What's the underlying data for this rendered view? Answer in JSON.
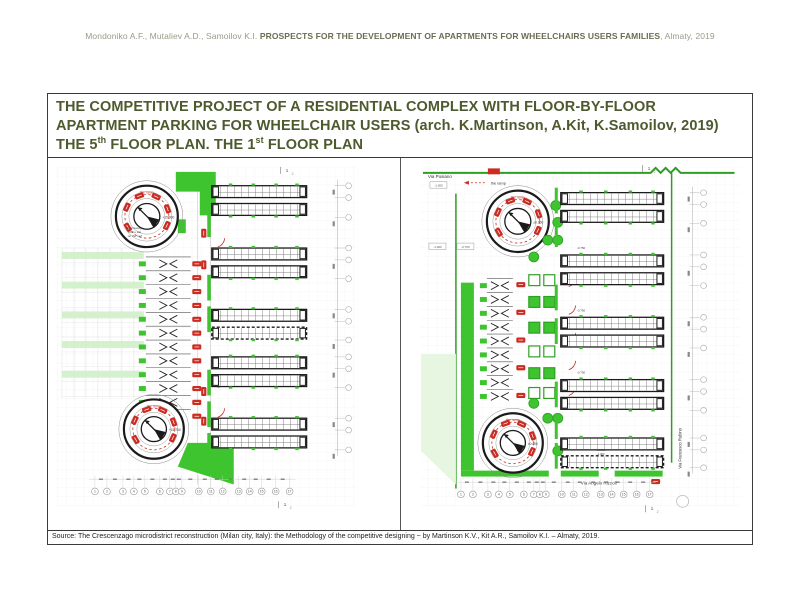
{
  "header": {
    "authors": "Mondoniko A.F., Mutaliev A.D., Samoilov K.I. ",
    "title_bold": "PROSPECTS FOR THE DEVELOPMENT OF APARTMENTS FOR WHEELCHAIRS USERS FAMILIES",
    "suffix": ", Almaty, 2019"
  },
  "title_block": {
    "line1": "THE COMPETITIVE PROJECT OF A RESIDENTIAL COMPLEX WITH FLOOR-BY-FLOOR",
    "line2": "APARTMENT PARKING FOR WHEELCHAIR USERS (arch. K.Martinson, A.Kit, K.Samoilov, 2019)",
    "line3_pre": "THE 5",
    "line3_sup1": "th",
    "line3_mid": " FLOOR PLAN. THE 1",
    "line3_sup2": "st",
    "line3_post": " FLOOR PLAN"
  },
  "source": {
    "text": "Source: The Crescenzago microdistrict reconstruction (Milan city, Italy): the Methodology of the competitive designing ~ by Martinson K.V., Kit A.R., Samoilov K.I. – Almaty, 2019."
  },
  "plans": {
    "left": {
      "name": "the-5th-floor-plan",
      "ramp_label": "the ramp",
      "ramp_note": [
        "the Passage",
        "to the site",
        "on the roof"
      ],
      "elevations": {
        "top_ramp": "+15.000",
        "bottom_ramp": "+15.750"
      },
      "grid_numbers": [
        "1",
        "2",
        "3",
        "4",
        "5",
        "6",
        "7",
        "8",
        "9",
        "10",
        "11",
        "12",
        "13",
        "14",
        "15",
        "16",
        "17"
      ],
      "section_mark_1": "1",
      "section_mark_2": "2"
    },
    "right": {
      "name": "the-1st-floor-plan",
      "streets": {
        "top": "Via Pusiano",
        "bottom": "Via Angelo Rizzoli",
        "right": "Via Francesco Rubino"
      },
      "legend_label": "the ramp",
      "level_box_top": "-1.000",
      "level_box_a": "-1.000",
      "level_box_b": "-0.750",
      "spot_elevations": [
        "-0.750",
        "-0.750",
        "-0.750"
      ],
      "stacked_elevations": [
        "±0.000",
        "-1.000"
      ],
      "elevations": {
        "top_ramp": "±0.000",
        "bottom_ramp": "±0.000"
      },
      "ramp_label": "the ramp",
      "grid_numbers": [
        "1",
        "2",
        "3",
        "4",
        "5",
        "6",
        "7",
        "8",
        "9",
        "10",
        "11",
        "12",
        "13",
        "14",
        "15",
        "16",
        "17"
      ],
      "section_mark_1": "1",
      "section_mark_2": "2"
    }
  },
  "colors": {
    "green": "#3ec42e",
    "dark_green": "#2f9e25",
    "pale_green": "#e7f6e0",
    "row_green": "#cdeec4",
    "red": "#cb2b20",
    "wall": "#1b1b1b",
    "title_olive": "#4d5a2e",
    "plan_text": "#444444"
  }
}
